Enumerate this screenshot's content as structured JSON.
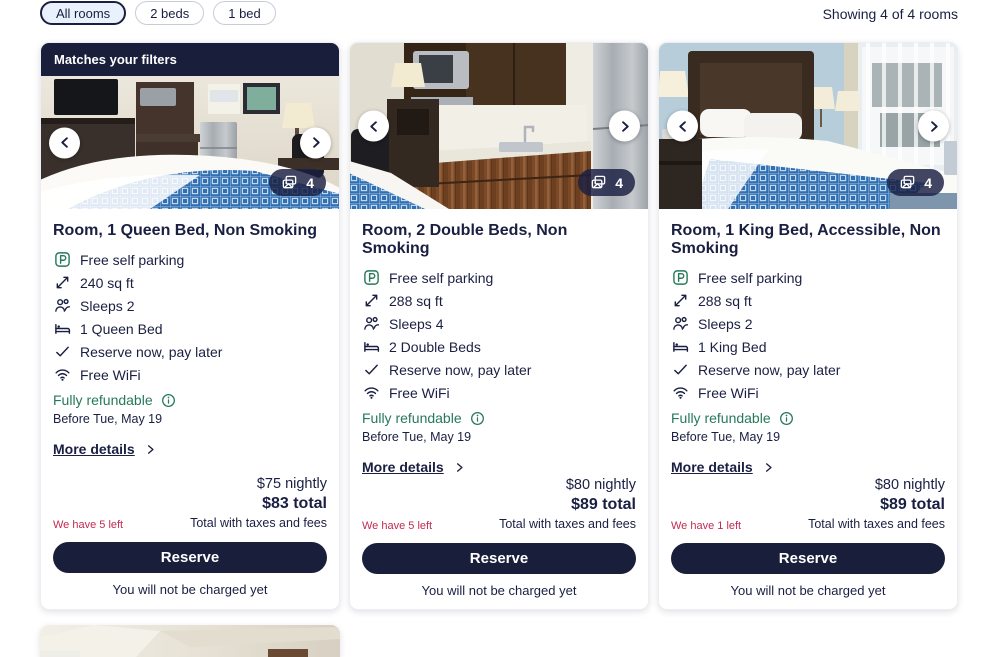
{
  "colors": {
    "navy": "#191e3b",
    "green": "#27795a",
    "crimson": "#c02b55",
    "chip_selected_bg": "#e9f2fc"
  },
  "filters": {
    "chips": [
      {
        "label": "All rooms",
        "selected": true
      },
      {
        "label": "2 beds",
        "selected": false
      },
      {
        "label": "1 bed",
        "selected": false
      }
    ],
    "showing": "Showing 4 of 4 rooms"
  },
  "cards": [
    {
      "banner": "Matches your filters",
      "photo_count": "4",
      "title": "Room, 1 Queen Bed, Non Smoking",
      "amenities": [
        {
          "icon": "parking-icon",
          "label": "Free self parking"
        },
        {
          "icon": "room-size-icon",
          "label": "240 sq ft"
        },
        {
          "icon": "sleeps-icon",
          "label": "Sleeps 2"
        },
        {
          "icon": "bed-icon",
          "label": "1 Queen Bed"
        },
        {
          "icon": "check-icon",
          "label": "Reserve now, pay later"
        },
        {
          "icon": "wifi-icon",
          "label": "Free WiFi"
        }
      ],
      "refundable": "Fully refundable",
      "refundable_note": "Before Tue, May 19",
      "more_details": "More details",
      "nightly": "$75 nightly",
      "total": "$83 total",
      "total_note": "Total with taxes and fees",
      "scarcity": "We have 5 left",
      "reserve_label": "Reserve",
      "no_charge": "You will not be charged yet"
    },
    {
      "banner": "",
      "photo_count": "4",
      "title": "Room, 2 Double Beds, Non Smoking",
      "amenities": [
        {
          "icon": "parking-icon",
          "label": "Free self parking"
        },
        {
          "icon": "room-size-icon",
          "label": "288 sq ft"
        },
        {
          "icon": "sleeps-icon",
          "label": "Sleeps 4"
        },
        {
          "icon": "bed-icon",
          "label": "2 Double Beds"
        },
        {
          "icon": "check-icon",
          "label": "Reserve now, pay later"
        },
        {
          "icon": "wifi-icon",
          "label": "Free WiFi"
        }
      ],
      "refundable": "Fully refundable",
      "refundable_note": "Before Tue, May 19",
      "more_details": "More details",
      "nightly": "$80 nightly",
      "total": "$89 total",
      "total_note": "Total with taxes and fees",
      "scarcity": "We have 5 left",
      "reserve_label": "Reserve",
      "no_charge": "You will not be charged yet"
    },
    {
      "banner": "",
      "photo_count": "4",
      "title": "Room, 1 King Bed, Accessible, Non Smoking",
      "amenities": [
        {
          "icon": "parking-icon",
          "label": "Free self parking"
        },
        {
          "icon": "room-size-icon",
          "label": "288 sq ft"
        },
        {
          "icon": "sleeps-icon",
          "label": "Sleeps 2"
        },
        {
          "icon": "bed-icon",
          "label": "1 King Bed"
        },
        {
          "icon": "check-icon",
          "label": "Reserve now, pay later"
        },
        {
          "icon": "wifi-icon",
          "label": "Free WiFi"
        }
      ],
      "refundable": "Fully refundable",
      "refundable_note": "Before Tue, May 19",
      "more_details": "More details",
      "nightly": "$80 nightly",
      "total": "$89 total",
      "total_note": "Total with taxes and fees",
      "scarcity": "We have 1 left",
      "reserve_label": "Reserve",
      "no_charge": "You will not be charged yet"
    }
  ]
}
